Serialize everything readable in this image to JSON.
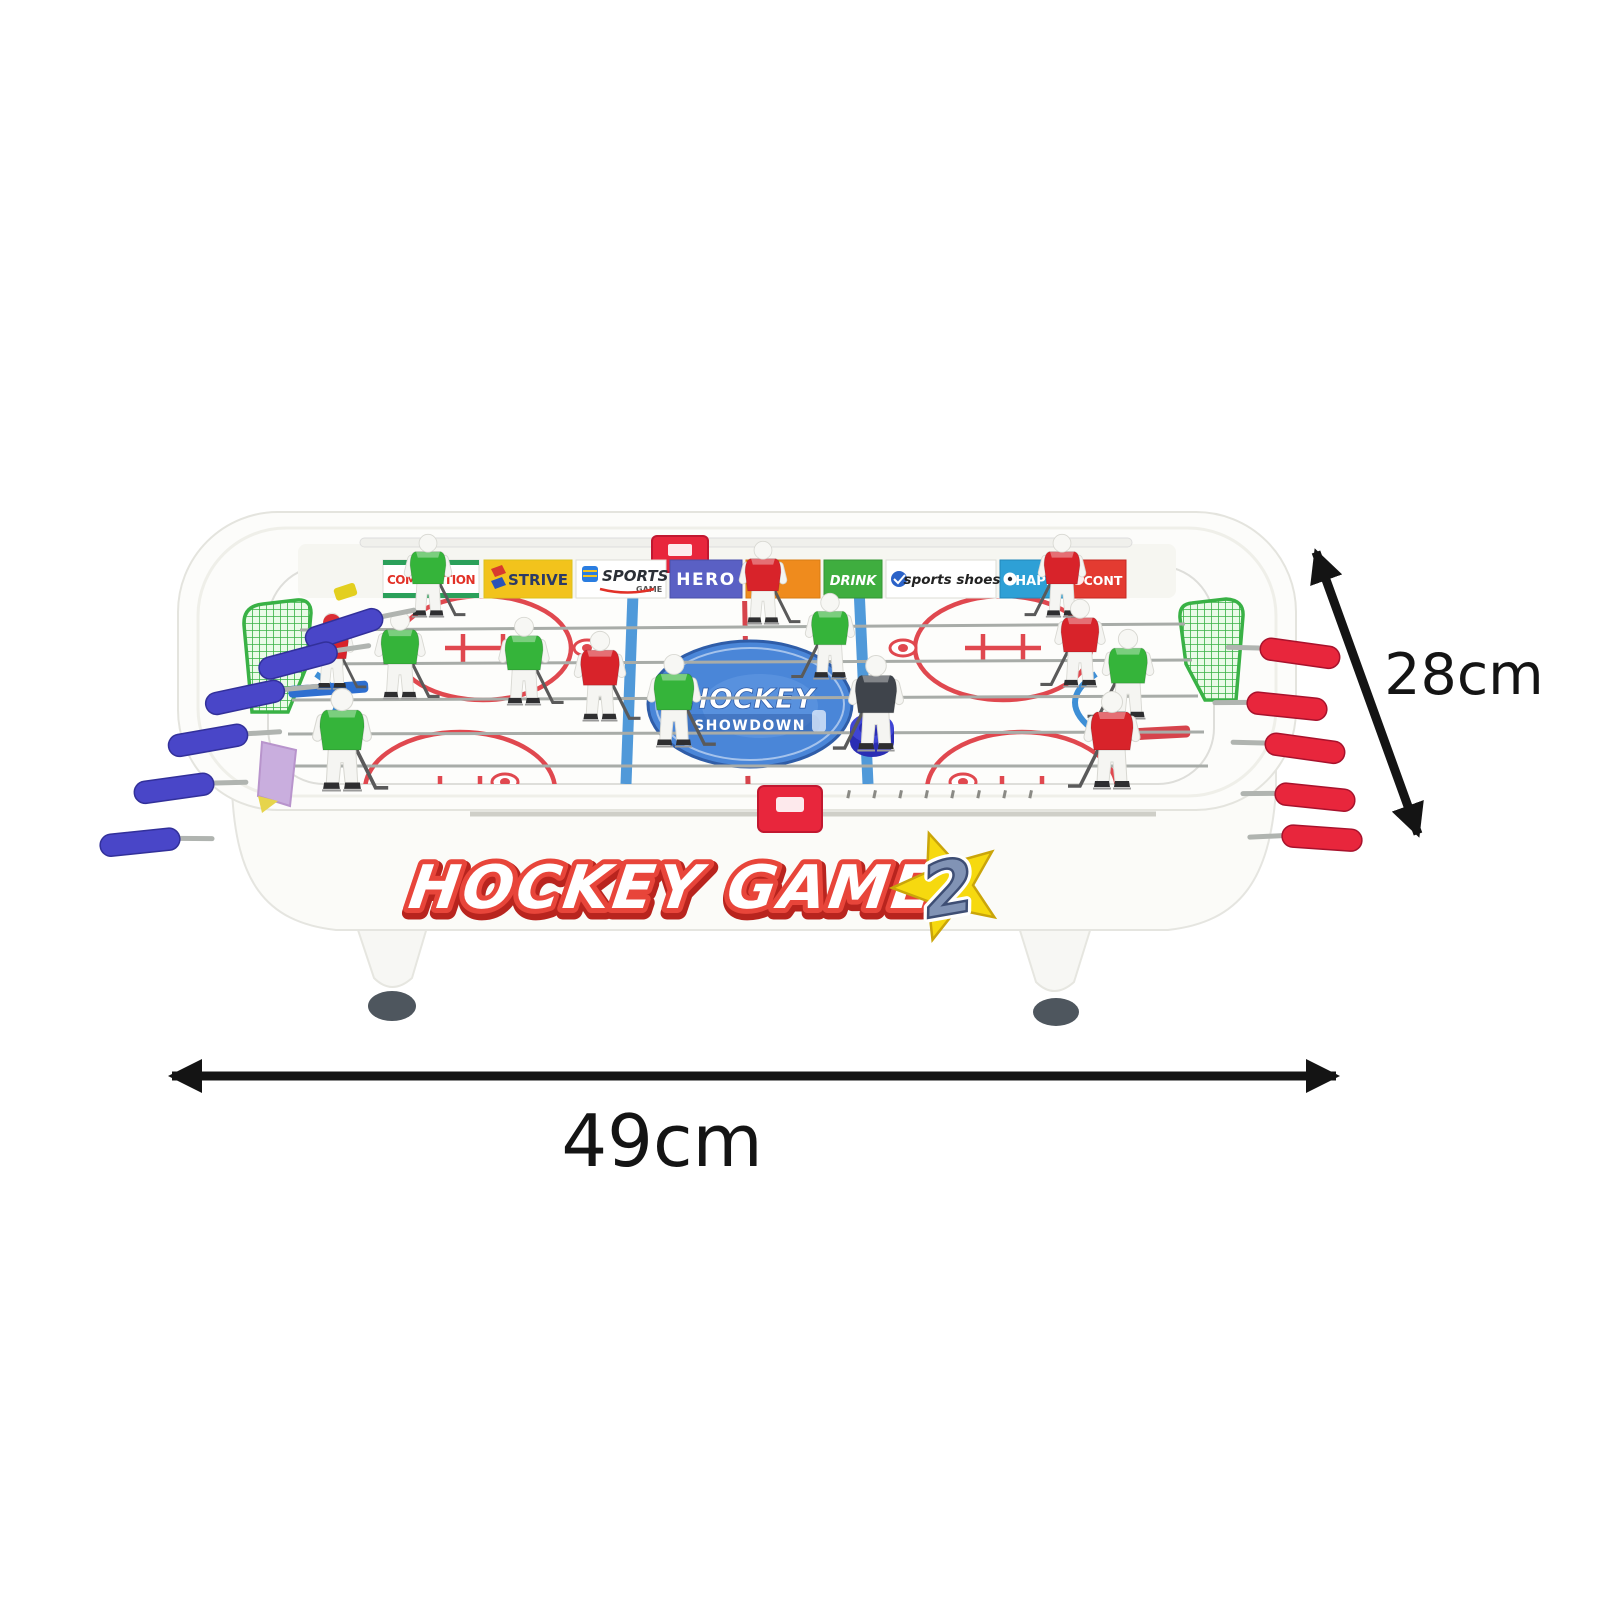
{
  "table": {
    "front_logo": {
      "text": "HOCKEY GAME",
      "number": "2",
      "text_color": "#ffffff",
      "outline_color": "#e8453a",
      "star_color": "#f6d90f",
      "number_color": "#8193b5"
    },
    "center_logo": {
      "title": "HOCKEY",
      "subtitle": "SHOWDOWN",
      "bg_color": "#4a86d8"
    },
    "banners": [
      {
        "label": "COMPETITION",
        "bg": "#ffffff",
        "fg": "#e23127",
        "stripe": "#2ba05a"
      },
      {
        "label": "STRIVE",
        "bg": "#f2c31c",
        "fg": "#2b3a66"
      },
      {
        "label": "SPORTS",
        "sublabel": "GAME",
        "bg": "#ffffff",
        "fg": "#2b2f36"
      },
      {
        "label": "HERO",
        "bg": "#5a60c4",
        "fg": "#ffffff"
      },
      {
        "label": "",
        "bg": "#ef8b1d",
        "fg": "#ffffff"
      },
      {
        "label": "DRINK",
        "bg": "#3fae3f",
        "fg": "#ffffff"
      },
      {
        "label": "sports shoes",
        "bg": "#ffffff",
        "fg": "#222222"
      },
      {
        "label": "HAPPY",
        "bg": "#2ea0d6",
        "fg": "#ffffff"
      },
      {
        "label": "CONT",
        "bg": "#e33b31",
        "fg": "#ffffff"
      }
    ],
    "team_colors": {
      "red": "#d8232a",
      "green": "#35b43a",
      "goalie_dark": "#3f444b"
    },
    "handle_colors": {
      "left": "#4946c8",
      "right": "#e8263c"
    },
    "goal_color": "#2fae3c",
    "puck_color": "#3036c8",
    "rink_marking_colors": {
      "red": "#d6444c",
      "blue": "#3e8fd6"
    }
  },
  "dimensions": {
    "width_label": "49cm",
    "depth_label": "28cm",
    "arrow_color": "#141414"
  }
}
